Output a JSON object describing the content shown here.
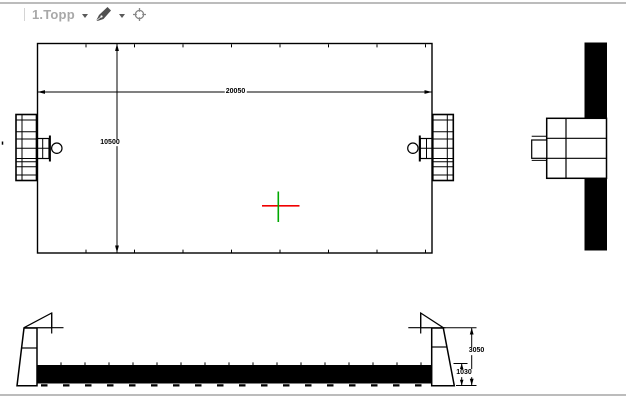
{
  "toolbar": {
    "view_name": "1.Topp",
    "pen_icon": "pen-icon",
    "crosshair_icon": "crosshair-target-icon",
    "dropdown_icon": "chevron-down-icon"
  },
  "drawing": {
    "top_view": {
      "width": "20050",
      "height": "10500"
    },
    "front_view": {
      "total_height": "3050",
      "lower_height": "1030"
    }
  },
  "colors": {
    "line": "#000000",
    "crosshair_horizontal": "#f00000",
    "crosshair_vertical": "#00a800",
    "toolbar_text": "#a8a8a8",
    "viewport_border": "#bcbcbc",
    "background": "#ffffff"
  }
}
